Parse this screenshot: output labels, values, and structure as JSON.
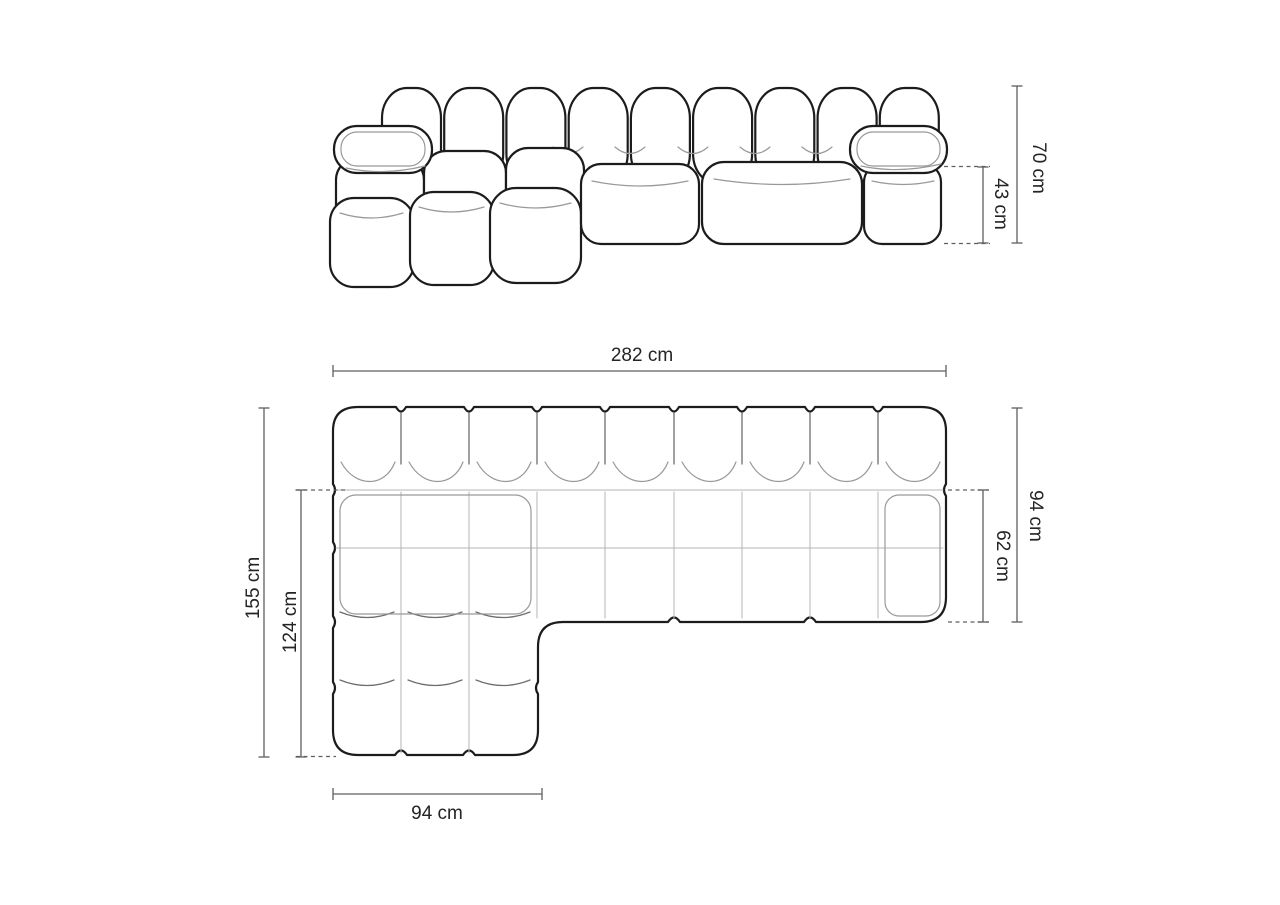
{
  "diagram": {
    "kind": "modular-sofa-dimension-drawing",
    "units": "cm"
  },
  "dimensions": {
    "total_width": "282 cm",
    "total_depth": "155 cm",
    "chaise_inner_depth": "124 cm",
    "chaise_width": "94 cm",
    "sofa_depth": "94 cm",
    "seat_depth": "62 cm",
    "total_height": "70 cm",
    "seat_height": "43 cm"
  },
  "colors": {
    "background": "#ffffff",
    "outline": "#1c1c1c",
    "seam": "#999999",
    "dimension_line": "#5f5f5f",
    "label_text": "#242424"
  }
}
